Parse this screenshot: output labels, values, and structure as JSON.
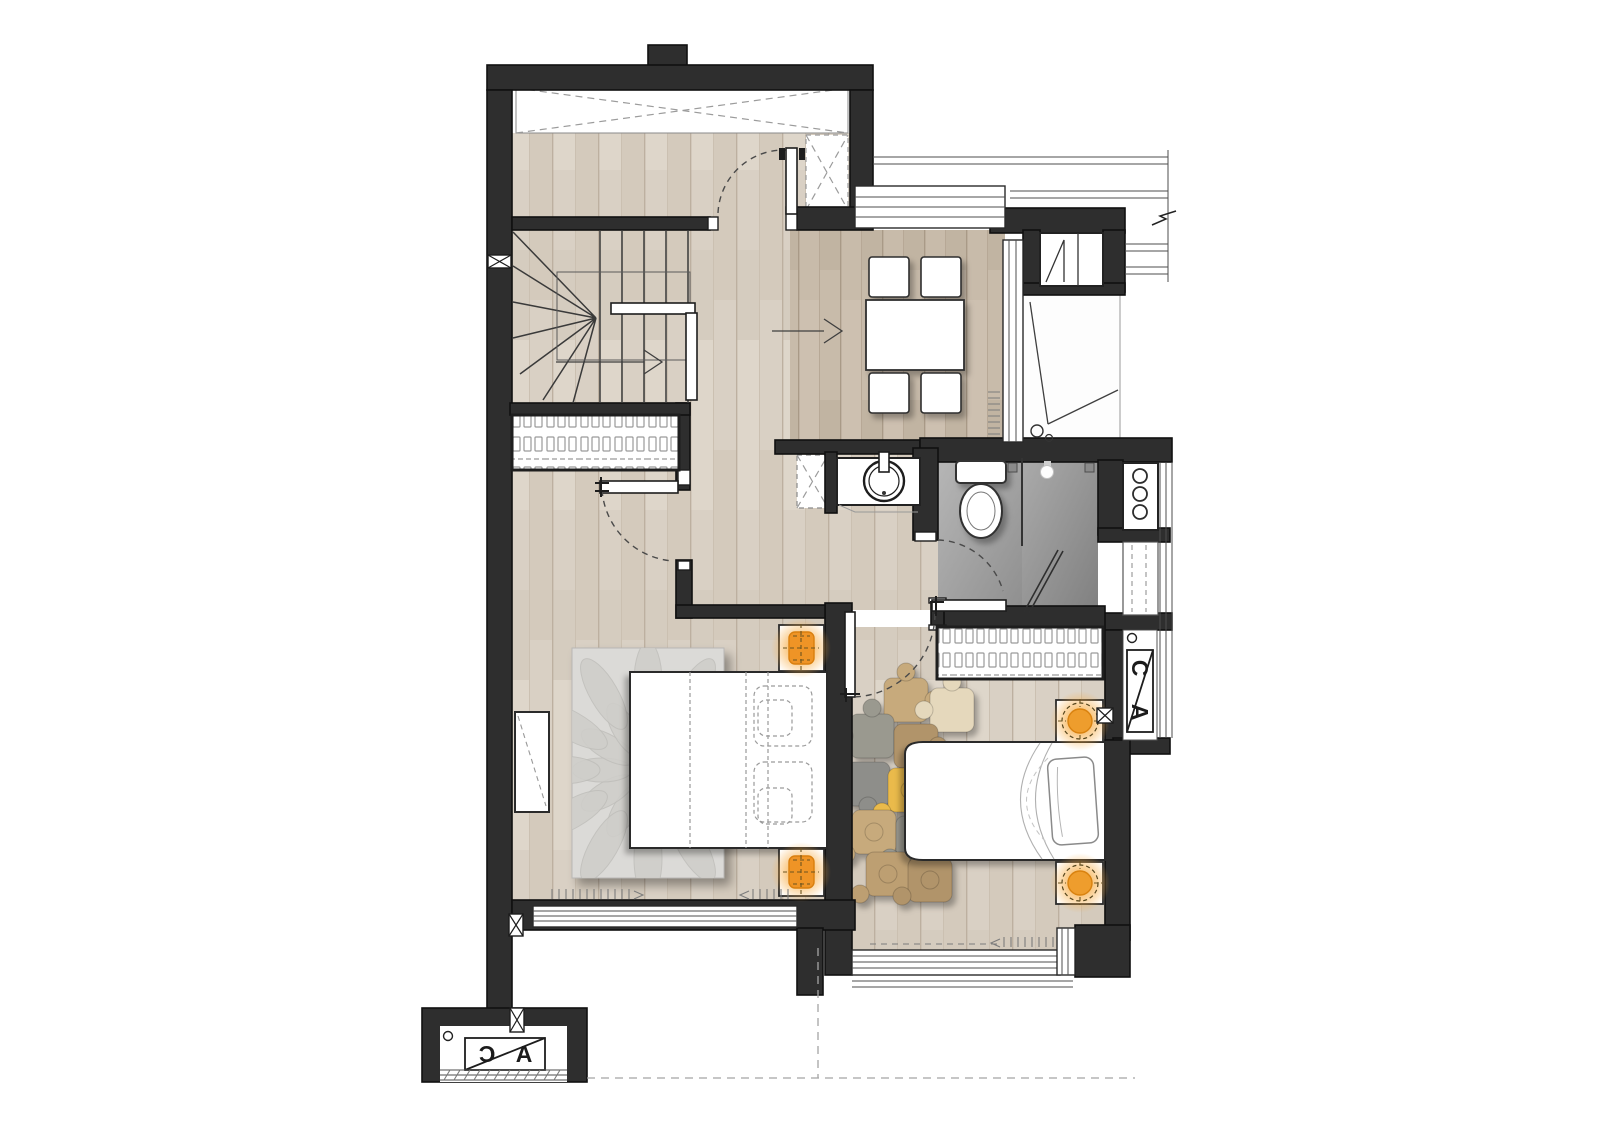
{
  "page": {
    "background": "#ffffff"
  },
  "plan": {
    "type": "residential-apartment-floor-plan",
    "section_markers": {
      "bottom_left": {
        "letter_low": "C",
        "letter_high": "A"
      },
      "right": {
        "letter_top": "C",
        "letter_bottom": "A"
      }
    },
    "colors": {
      "wall": "#2e2e2e",
      "wall-outline": "#101010",
      "floor-wood": "#d9d0c4",
      "floor-wood-dark": "#c8bbaa",
      "bath-floor": "#9c9c9c",
      "accent-lamp": "#ef9426",
      "rug-gray": "#dbdad7",
      "annotation": "#9b9b9b"
    },
    "icons": {
      "stair_direction": "arrow-right-icon",
      "entry_flow": "arrow-right-icon",
      "ceiling_light": "bulb-icon",
      "bedside_lamp": "glow-lamp-icon",
      "void_area": "x-cross-icon",
      "wall_joint": "bowtie-icon",
      "wall_break": "break-mark-icon"
    }
  }
}
